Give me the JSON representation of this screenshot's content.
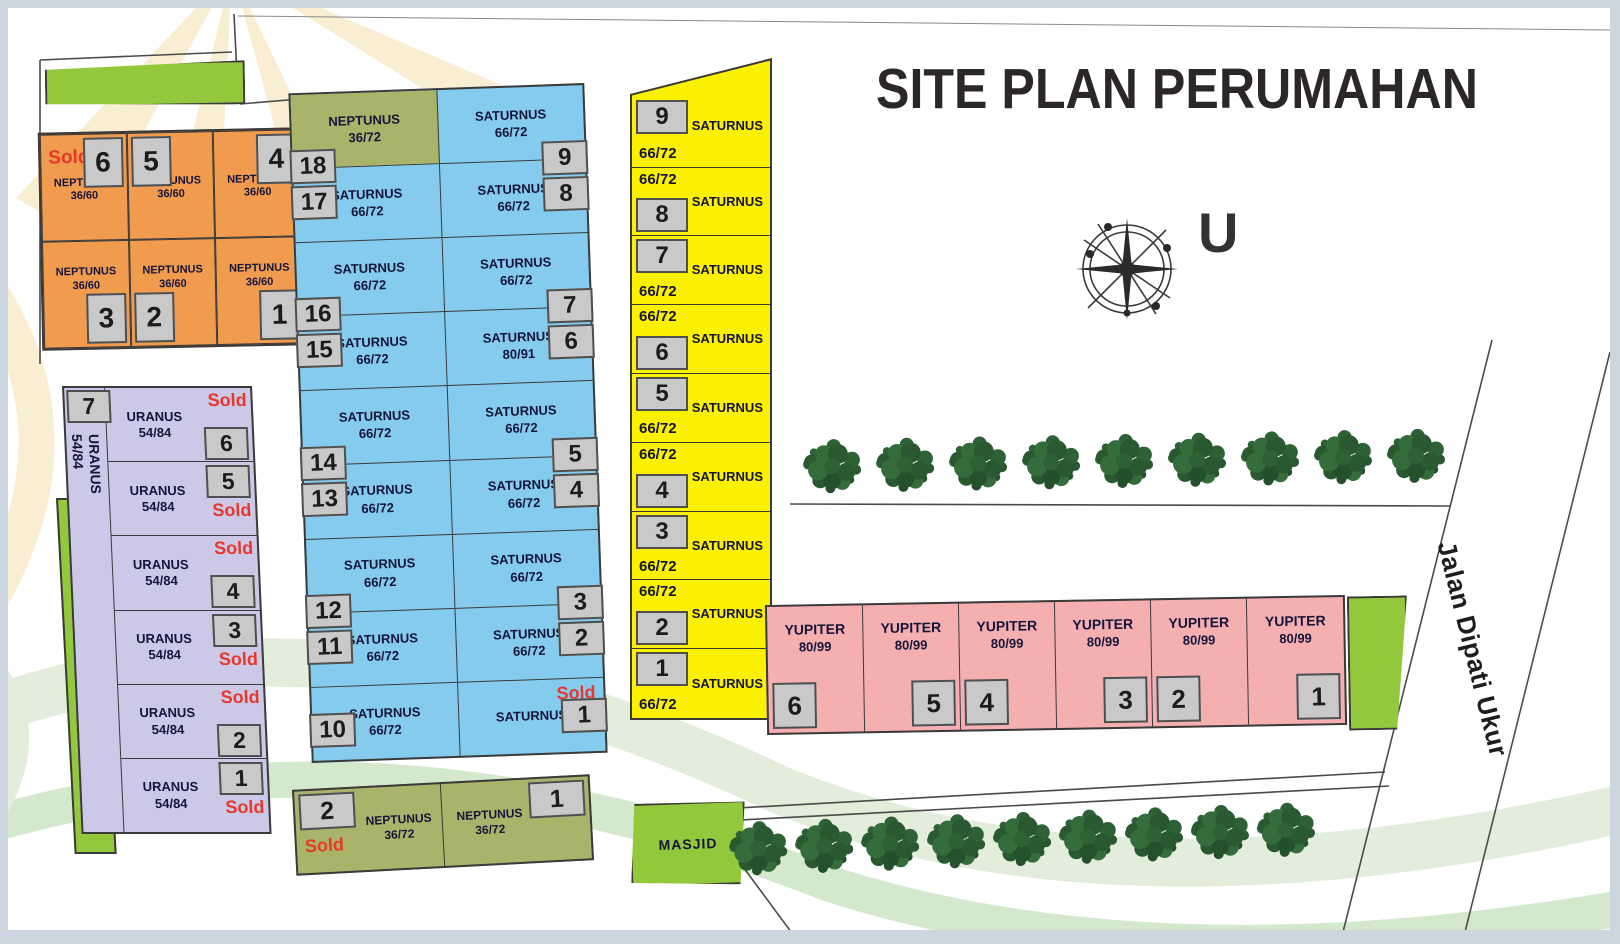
{
  "page": {
    "title": "SITE PLAN PERUMAHAN",
    "north_label": "U",
    "street_label": "Jalan Dipati Ukur"
  },
  "colors": {
    "orange": "#F09B4E",
    "purple": "#CCC8E8",
    "blue": "#85CBEE",
    "yellow": "#FBF000",
    "pink": "#F5AFB1",
    "olive": "#A9B36A",
    "green": "#93C83D",
    "tag": "#C9C9C9",
    "red": "#E8382B",
    "navy": "#15153A"
  },
  "blocks": {
    "neptunus_a": {
      "type_label": "NEPTUNUS 36/60",
      "units": [
        {
          "nm": "NEPTUNUS",
          "sz": "36/60",
          "tag": "6",
          "tagpos": "tr",
          "sold": "Sold",
          "rowcls": "r1"
        },
        {
          "nm": "NEPTUNUS",
          "sz": "36/60",
          "tag": "5",
          "tagpos": "tl",
          "rowcls": "r1"
        },
        {
          "nm": "NEPTUNUS",
          "sz": "36/60",
          "tag": "4",
          "tagpos": "tr",
          "rowcls": "r1"
        },
        {
          "nm": "NEPTUNUS",
          "sz": "36/60",
          "tag": "3",
          "tagpos": "br",
          "rowcls": "r2"
        },
        {
          "nm": "NEPTUNUS",
          "sz": "36/60",
          "tag": "2",
          "tagpos": "bl",
          "rowcls": "r2"
        },
        {
          "nm": "NEPTUNUS",
          "sz": "36/60",
          "tag": "1",
          "tagpos": "br",
          "rowcls": "r2"
        }
      ]
    },
    "uranus": {
      "strip_tag": "7",
      "strip_nm": "URANUS",
      "strip_sz": "54/84",
      "units": [
        {
          "nm": "URANUS",
          "sz": "54/84",
          "top_sold": "Sold",
          "bot_tag": "6"
        },
        {
          "nm": "URANUS",
          "sz": "54/84",
          "top_tag": "5",
          "bot_sold": "Sold"
        },
        {
          "nm": "URANUS",
          "sz": "54/84",
          "top_sold": "Sold",
          "bot_tag": "4"
        },
        {
          "nm": "URANUS",
          "sz": "54/84",
          "top_tag": "3",
          "bot_sold": "Sold"
        },
        {
          "nm": "URANUS",
          "sz": "54/84",
          "top_sold": "Sold",
          "bot_tag": "2"
        },
        {
          "nm": "URANUS",
          "sz": "54/84",
          "top_tag": "1",
          "bot_sold": "Sold"
        }
      ]
    },
    "saturnus_blue": {
      "bands": [
        {
          "l_nm": "NEPTUNUS",
          "l_sz": "36/72",
          "l_cls": "olv",
          "r_nm": "SATURNUS",
          "r_sz": "66/72"
        },
        {
          "l_nm": "SATURNUS",
          "l_sz": "66/72",
          "r_nm": "SATURNUS",
          "r_sz": "66/72",
          "lt1": "18",
          "lt2": "17",
          "rt1": "9",
          "rt2": "8"
        },
        {
          "l_nm": "SATURNUS",
          "l_sz": "66/72",
          "r_nm": "SATURNUS",
          "r_sz": "66/72"
        },
        {
          "l_nm": "SATURNUS",
          "l_sz": "66/72",
          "r_nm": "SATURNUS",
          "r_sz": "80/91",
          "lt1": "16",
          "lt2": "15",
          "rt1": "7",
          "rt2": "6"
        },
        {
          "l_nm": "SATURNUS",
          "l_sz": "66/72",
          "r_nm": "SATURNUS",
          "r_sz": "66/72"
        },
        {
          "l_nm": "SATURNUS",
          "l_sz": "66/72",
          "r_nm": "SATURNUS",
          "r_sz": "66/72",
          "lt1": "14",
          "lt2": "13",
          "rt1": "5",
          "rt2": "4"
        },
        {
          "l_nm": "SATURNUS",
          "l_sz": "66/72",
          "r_nm": "SATURNUS",
          "r_sz": "66/72"
        },
        {
          "l_nm": "SATURNUS",
          "l_sz": "66/72",
          "r_nm": "SATURNUS",
          "r_sz": "66/72",
          "lt1": "12",
          "lt2": "11",
          "rt1": "3",
          "rt2": "2"
        },
        {
          "l_nm": "SATURNUS",
          "l_sz": "66/72",
          "r_nm": "SATURNUS",
          "r_sold": "Sold",
          "ltL": "10",
          "rtL": "1"
        }
      ]
    },
    "saturnus_yellow": {
      "units": [
        {
          "tag": "9",
          "nm": "SATURNUS",
          "sz": "66/72",
          "layout": "tag-top first"
        },
        {
          "tag": "8",
          "nm": "SATURNUS",
          "sz": "66/72",
          "layout": "tag-bot"
        },
        {
          "tag": "7",
          "nm": "SATURNUS",
          "sz": "66/72",
          "layout": "tag-top"
        },
        {
          "tag": "6",
          "nm": "SATURNUS",
          "sz": "66/72",
          "layout": "tag-bot"
        },
        {
          "tag": "5",
          "nm": "SATURNUS",
          "sz": "66/72",
          "layout": "tag-top"
        },
        {
          "tag": "4",
          "nm": "SATURNUS",
          "sz": "66/72",
          "layout": "tag-bot"
        },
        {
          "tag": "3",
          "nm": "SATURNUS",
          "sz": "66/72",
          "layout": "tag-top"
        },
        {
          "tag": "2",
          "nm": "SATURNUS",
          "sz": "66/72",
          "layout": "tag-bot"
        },
        {
          "tag": "1",
          "nm": "SATURNUS",
          "sz": "66/72",
          "layout": "tag-top"
        }
      ]
    },
    "yupiter": {
      "units": [
        {
          "nm": "YUPITER",
          "sz": "80/99",
          "tag": "6",
          "tagpos": "bl"
        },
        {
          "nm": "YUPITER",
          "sz": "80/99",
          "tag": "5",
          "tagpos": "br"
        },
        {
          "nm": "YUPITER",
          "sz": "80/99",
          "tag": "4",
          "tagpos": "bl"
        },
        {
          "nm": "YUPITER",
          "sz": "80/99",
          "tag": "3",
          "tagpos": "br"
        },
        {
          "nm": "YUPITER",
          "sz": "80/99",
          "tag": "2",
          "tagpos": "bl"
        },
        {
          "nm": "YUPITER",
          "sz": "80/99",
          "tag": "1",
          "tagpos": "br"
        }
      ]
    },
    "neptunus_b": {
      "units": [
        {
          "nm": "NEPTUNUS",
          "sz": "36/72",
          "tag": "2",
          "tagpos": "tl",
          "sold": "Sold",
          "cls": "c1"
        },
        {
          "nm": "NEPTUNUS",
          "sz": "36/72",
          "tag": "1",
          "tagpos": "tr",
          "cls": "c2"
        }
      ]
    },
    "masjid": {
      "label": "MASJID"
    }
  },
  "landscape": {
    "tree_rows": [
      {
        "count": 9,
        "items": [
          {},
          {},
          {},
          {},
          {},
          {},
          {},
          {},
          {}
        ]
      },
      {
        "count": 9,
        "items": [
          {},
          {},
          {},
          {},
          {},
          {},
          {},
          {},
          {}
        ]
      }
    ]
  }
}
